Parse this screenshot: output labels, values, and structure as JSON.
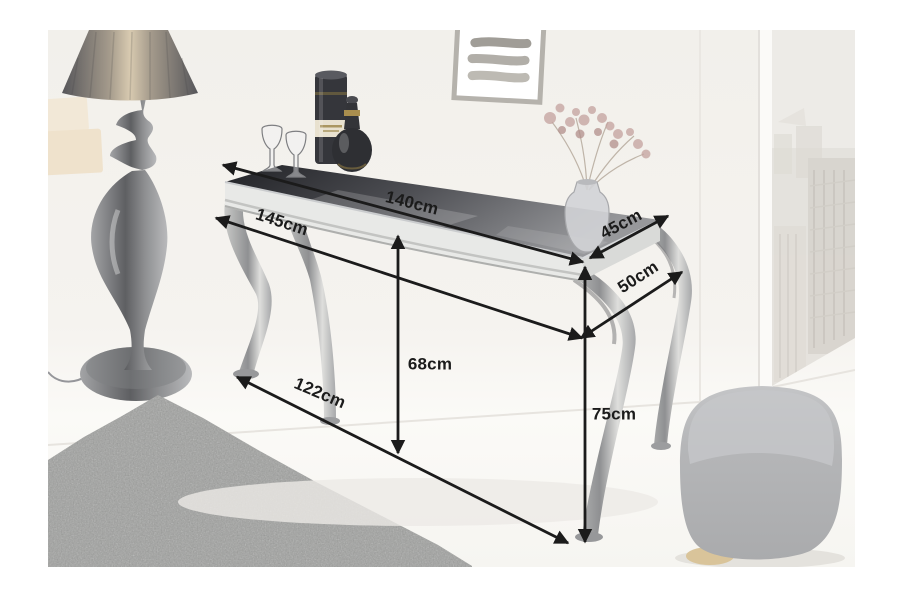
{
  "image": {
    "type": "furniture-dimension-photo",
    "subject": "baroque console table with black glass top and chrome legs",
    "page_background": "#ffffff"
  },
  "dimensions": [
    {
      "id": "top-length",
      "label": "140cm"
    },
    {
      "id": "overall-length",
      "label": "145cm"
    },
    {
      "id": "top-depth",
      "label": "45cm"
    },
    {
      "id": "overall-depth",
      "label": "50cm"
    },
    {
      "id": "clearance-height",
      "label": "68cm"
    },
    {
      "id": "floor-span",
      "label": "122cm"
    },
    {
      "id": "overall-height",
      "label": "75cm"
    }
  ],
  "colors": {
    "annotation": "#1b1b1b",
    "glass_top_dark": "#26272b",
    "glass_top_light": "#97989b",
    "chrome": "#e0e1df",
    "wall": "#f4f2ee",
    "rug": "#9fa09e",
    "pouf": "#b5b6b8",
    "pouf_base_gold": "#d9c49a"
  }
}
